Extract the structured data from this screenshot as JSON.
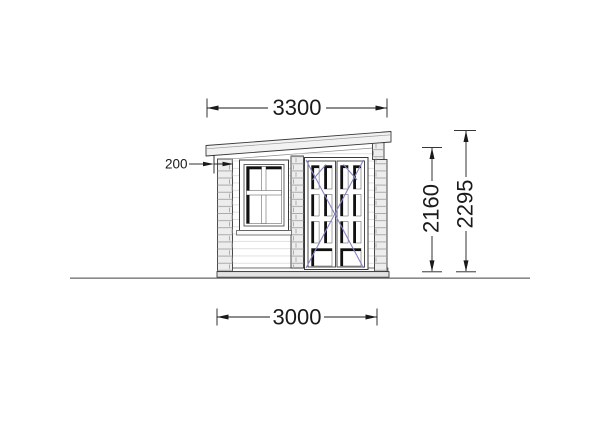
{
  "drawing": {
    "type": "technical-elevation-side-view",
    "dimensions": {
      "roof_length": "3300",
      "roof_overhang": "200",
      "wall_height": "2160",
      "total_height": "2295",
      "wall_length": "3000"
    },
    "colors": {
      "outline": "#3a3a3a",
      "dim": "#1a1a1a",
      "board_line": "#dcdcdc",
      "log_fill": "#ededed",
      "roof_fill": "#f2f2f2",
      "base_fill": "#e3e3e3",
      "glass_dark": "#111111",
      "swing_blue": "#8585c7",
      "ground": "#8a8a8a"
    }
  }
}
